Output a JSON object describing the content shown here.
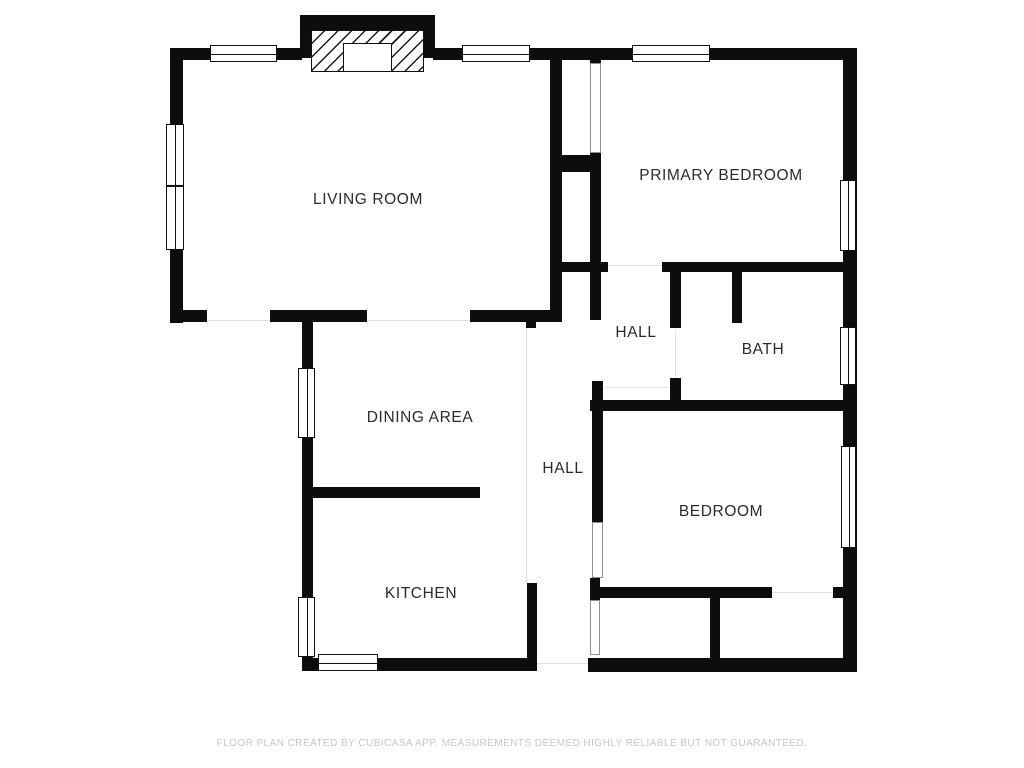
{
  "footer": {
    "text": "FLOOR PLAN CREATED BY CUBICASA APP. MEASUREMENTS DEEMED HIGHLY RELIABLE BUT NOT GUARANTEED."
  },
  "colors": {
    "wall": "#0d0d0d",
    "label": "#2b2b2b",
    "footer_text": "#c6c6c6",
    "background": "#ffffff"
  },
  "rooms": [
    {
      "id": "living-room",
      "label": "LIVING ROOM",
      "cx": 368,
      "cy": 200
    },
    {
      "id": "primary-bedroom",
      "label": "PRIMARY BEDROOM",
      "cx": 721,
      "cy": 176
    },
    {
      "id": "hall-upper",
      "label": "HALL",
      "cx": 636,
      "cy": 333
    },
    {
      "id": "bath",
      "label": "BATH",
      "cx": 763,
      "cy": 350
    },
    {
      "id": "dining-area",
      "label": "DINING AREA",
      "cx": 420,
      "cy": 418
    },
    {
      "id": "hall-lower",
      "label": "HALL",
      "cx": 563,
      "cy": 469
    },
    {
      "id": "kitchen",
      "label": "KITCHEN",
      "cx": 421,
      "cy": 594
    },
    {
      "id": "bedroom",
      "label": "BEDROOM",
      "cx": 721,
      "cy": 512
    }
  ],
  "plan": {
    "walls": [
      {
        "name": "exterior-top-wall-left",
        "x": 170,
        "y": 48,
        "w": 132,
        "h": 12
      },
      {
        "name": "exterior-top-wall-right",
        "x": 433,
        "y": 48,
        "w": 424,
        "h": 12
      },
      {
        "name": "exterior-left-wall",
        "x": 170,
        "y": 48,
        "w": 13,
        "h": 275
      },
      {
        "name": "exterior-right-wall",
        "x": 843,
        "y": 48,
        "w": 14,
        "h": 624
      },
      {
        "name": "living-bottom-wall-a",
        "x": 170,
        "y": 310,
        "w": 37,
        "h": 12
      },
      {
        "name": "living-bottom-wall-b",
        "x": 270,
        "y": 310,
        "w": 97,
        "h": 12
      },
      {
        "name": "living-bottom-wall-c",
        "x": 470,
        "y": 310,
        "w": 92,
        "h": 12
      },
      {
        "name": "living-east-wall",
        "x": 550,
        "y": 60,
        "w": 12,
        "h": 262
      },
      {
        "name": "exterior-bottom-wall-left",
        "x": 302,
        "y": 658,
        "w": 235,
        "h": 13
      },
      {
        "name": "exterior-bottom-wall-right",
        "x": 588,
        "y": 658,
        "w": 269,
        "h": 14
      },
      {
        "name": "dining-kitchen-left-wall",
        "x": 302,
        "y": 322,
        "w": 11,
        "h": 336
      },
      {
        "name": "fireplace-top",
        "x": 300,
        "y": 15,
        "w": 135,
        "h": 15
      },
      {
        "name": "fireplace-side-left",
        "x": 300,
        "y": 15,
        "w": 11,
        "h": 43
      },
      {
        "name": "fireplace-side-right",
        "x": 424,
        "y": 15,
        "w": 11,
        "h": 43
      },
      {
        "name": "primary-closet-connector",
        "x": 562,
        "y": 155,
        "w": 39,
        "h": 17
      },
      {
        "name": "primary-west-nub",
        "x": 590,
        "y": 60,
        "w": 11,
        "h": 5
      },
      {
        "name": "primary-west-wall",
        "x": 590,
        "y": 153,
        "w": 11,
        "h": 167
      },
      {
        "name": "hall-north-wall",
        "x": 562,
        "y": 262,
        "w": 46,
        "h": 10
      },
      {
        "name": "primary-south-wall",
        "x": 662,
        "y": 262,
        "w": 181,
        "h": 10
      },
      {
        "name": "bath-west-wall-upper",
        "x": 670,
        "y": 272,
        "w": 11,
        "h": 56
      },
      {
        "name": "bath-west-stub",
        "x": 670,
        "y": 378,
        "w": 11,
        "h": 24
      },
      {
        "name": "bath-inner-stub",
        "x": 732,
        "y": 272,
        "w": 10,
        "h": 51
      },
      {
        "name": "bath-south-wall",
        "x": 590,
        "y": 400,
        "w": 267,
        "h": 11
      },
      {
        "name": "bedroom-west-wall",
        "x": 592,
        "y": 381,
        "w": 11,
        "h": 141
      },
      {
        "name": "bedroom-west-stub",
        "x": 590,
        "y": 578,
        "w": 10,
        "h": 22
      },
      {
        "name": "bedroom-south-wall",
        "x": 600,
        "y": 587,
        "w": 172,
        "h": 11
      },
      {
        "name": "bedroom-south-wall-right",
        "x": 833,
        "y": 587,
        "w": 24,
        "h": 11
      },
      {
        "name": "closet-divider-wall",
        "x": 710,
        "y": 598,
        "w": 10,
        "h": 60
      },
      {
        "name": "dining-kitchen-divider",
        "x": 313,
        "y": 487,
        "w": 167,
        "h": 11
      },
      {
        "name": "kitchen-east-wall",
        "x": 527,
        "y": 583,
        "w": 10,
        "h": 75
      },
      {
        "name": "hall-corner-stub",
        "x": 526,
        "y": 322,
        "w": 10,
        "h": 6
      }
    ],
    "windows": [
      {
        "name": "window-living-top-left",
        "o": "h",
        "x": 210,
        "y": 45,
        "w": 67,
        "h": 17
      },
      {
        "name": "window-living-top-right",
        "o": "h",
        "x": 462,
        "y": 45,
        "w": 68,
        "h": 17
      },
      {
        "name": "window-primary-top",
        "o": "h",
        "x": 632,
        "y": 45,
        "w": 78,
        "h": 17
      },
      {
        "name": "window-living-left-upper",
        "o": "v",
        "x": 166,
        "y": 124,
        "w": 18,
        "h": 62
      },
      {
        "name": "window-living-left-lower",
        "o": "v",
        "x": 166,
        "y": 186,
        "w": 18,
        "h": 64
      },
      {
        "name": "window-dining-left",
        "o": "v",
        "x": 298,
        "y": 368,
        "w": 17,
        "h": 70
      },
      {
        "name": "window-kitchen-left",
        "o": "v",
        "x": 298,
        "y": 597,
        "w": 17,
        "h": 60
      },
      {
        "name": "window-kitchen-bottom",
        "o": "h",
        "x": 318,
        "y": 654,
        "w": 60,
        "h": 17
      },
      {
        "name": "window-primary-right",
        "o": "v",
        "x": 840,
        "y": 180,
        "w": 16,
        "h": 71
      },
      {
        "name": "window-bath-right",
        "o": "v",
        "x": 840,
        "y": 327,
        "w": 16,
        "h": 58
      },
      {
        "name": "window-bedroom-right",
        "o": "v",
        "x": 841,
        "y": 446,
        "w": 15,
        "h": 102
      }
    ],
    "thin_doors": [
      {
        "name": "primary-closet-door",
        "x": 590,
        "y": 63,
        "w": 11,
        "h": 90
      },
      {
        "name": "hall-closet-door",
        "x": 590,
        "y": 600,
        "w": 10,
        "h": 55
      },
      {
        "name": "bedroom-door",
        "x": 592,
        "y": 522,
        "w": 11,
        "h": 56
      }
    ],
    "thresholds": [
      {
        "name": "front-door-opening",
        "x": 207,
        "y": 320,
        "w": 63,
        "h": 1
      },
      {
        "name": "living-dining-opening",
        "x": 367,
        "y": 320,
        "w": 103,
        "h": 1
      },
      {
        "name": "primary-door-opening",
        "x": 608,
        "y": 265,
        "w": 54,
        "h": 1
      },
      {
        "name": "bath-door-opening",
        "x": 675,
        "y": 330,
        "w": 1,
        "h": 48
      },
      {
        "name": "hall-niche-opening",
        "x": 605,
        "y": 387,
        "w": 63,
        "h": 1
      },
      {
        "name": "closet-door-opening",
        "x": 772,
        "y": 592,
        "w": 61,
        "h": 1
      },
      {
        "name": "back-door-opening",
        "x": 537,
        "y": 663,
        "w": 51,
        "h": 1
      },
      {
        "name": "open-plan-divider",
        "x": 526,
        "y": 328,
        "w": 1,
        "h": 255
      }
    ],
    "fireplace": {
      "hatch": {
        "name": "fireplace-chimney-hatch",
        "x": 311,
        "y": 30,
        "w": 113,
        "h": 42
      },
      "box": {
        "name": "fireplace-firebox",
        "x": 343,
        "y": 43,
        "w": 49,
        "h": 29
      }
    }
  }
}
